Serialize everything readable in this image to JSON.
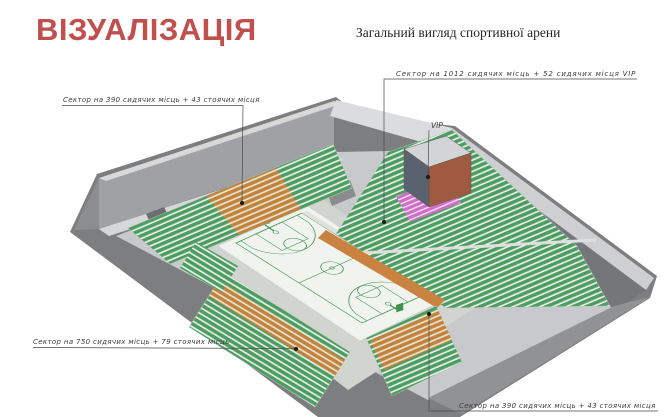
{
  "header": {
    "title": "ВІЗУАЛІЗАЦІЯ",
    "subtitle": "Загальний вигляд спортивної арени"
  },
  "callouts": {
    "upper_left": {
      "label": "Сектор на 390 сидячих місць + 43 стоячих місця"
    },
    "right": {
      "label": "Сектор на 1012 сидячих місць + 52 сидячих місця VIP"
    },
    "vip": {
      "label": "VIP"
    },
    "lower_left": {
      "label": "Сектор на 750 сидячих місць + 79 стоячих місць"
    },
    "lower_right": {
      "label": "Сектор на 390 сидячих місць + 43 стоячих місця"
    }
  },
  "colors": {
    "title_red": "#c0504d",
    "seat_green": "#4e9d62",
    "seat_orange": "#c08440",
    "seat_pink": "#cf6ec6",
    "shell_gray": "#7c7e80",
    "court_line_green": "#3f9150",
    "bench_blue": "#5a6fa0",
    "vip_box_left": "#5a6270",
    "vip_box_right": "#a05a41"
  }
}
